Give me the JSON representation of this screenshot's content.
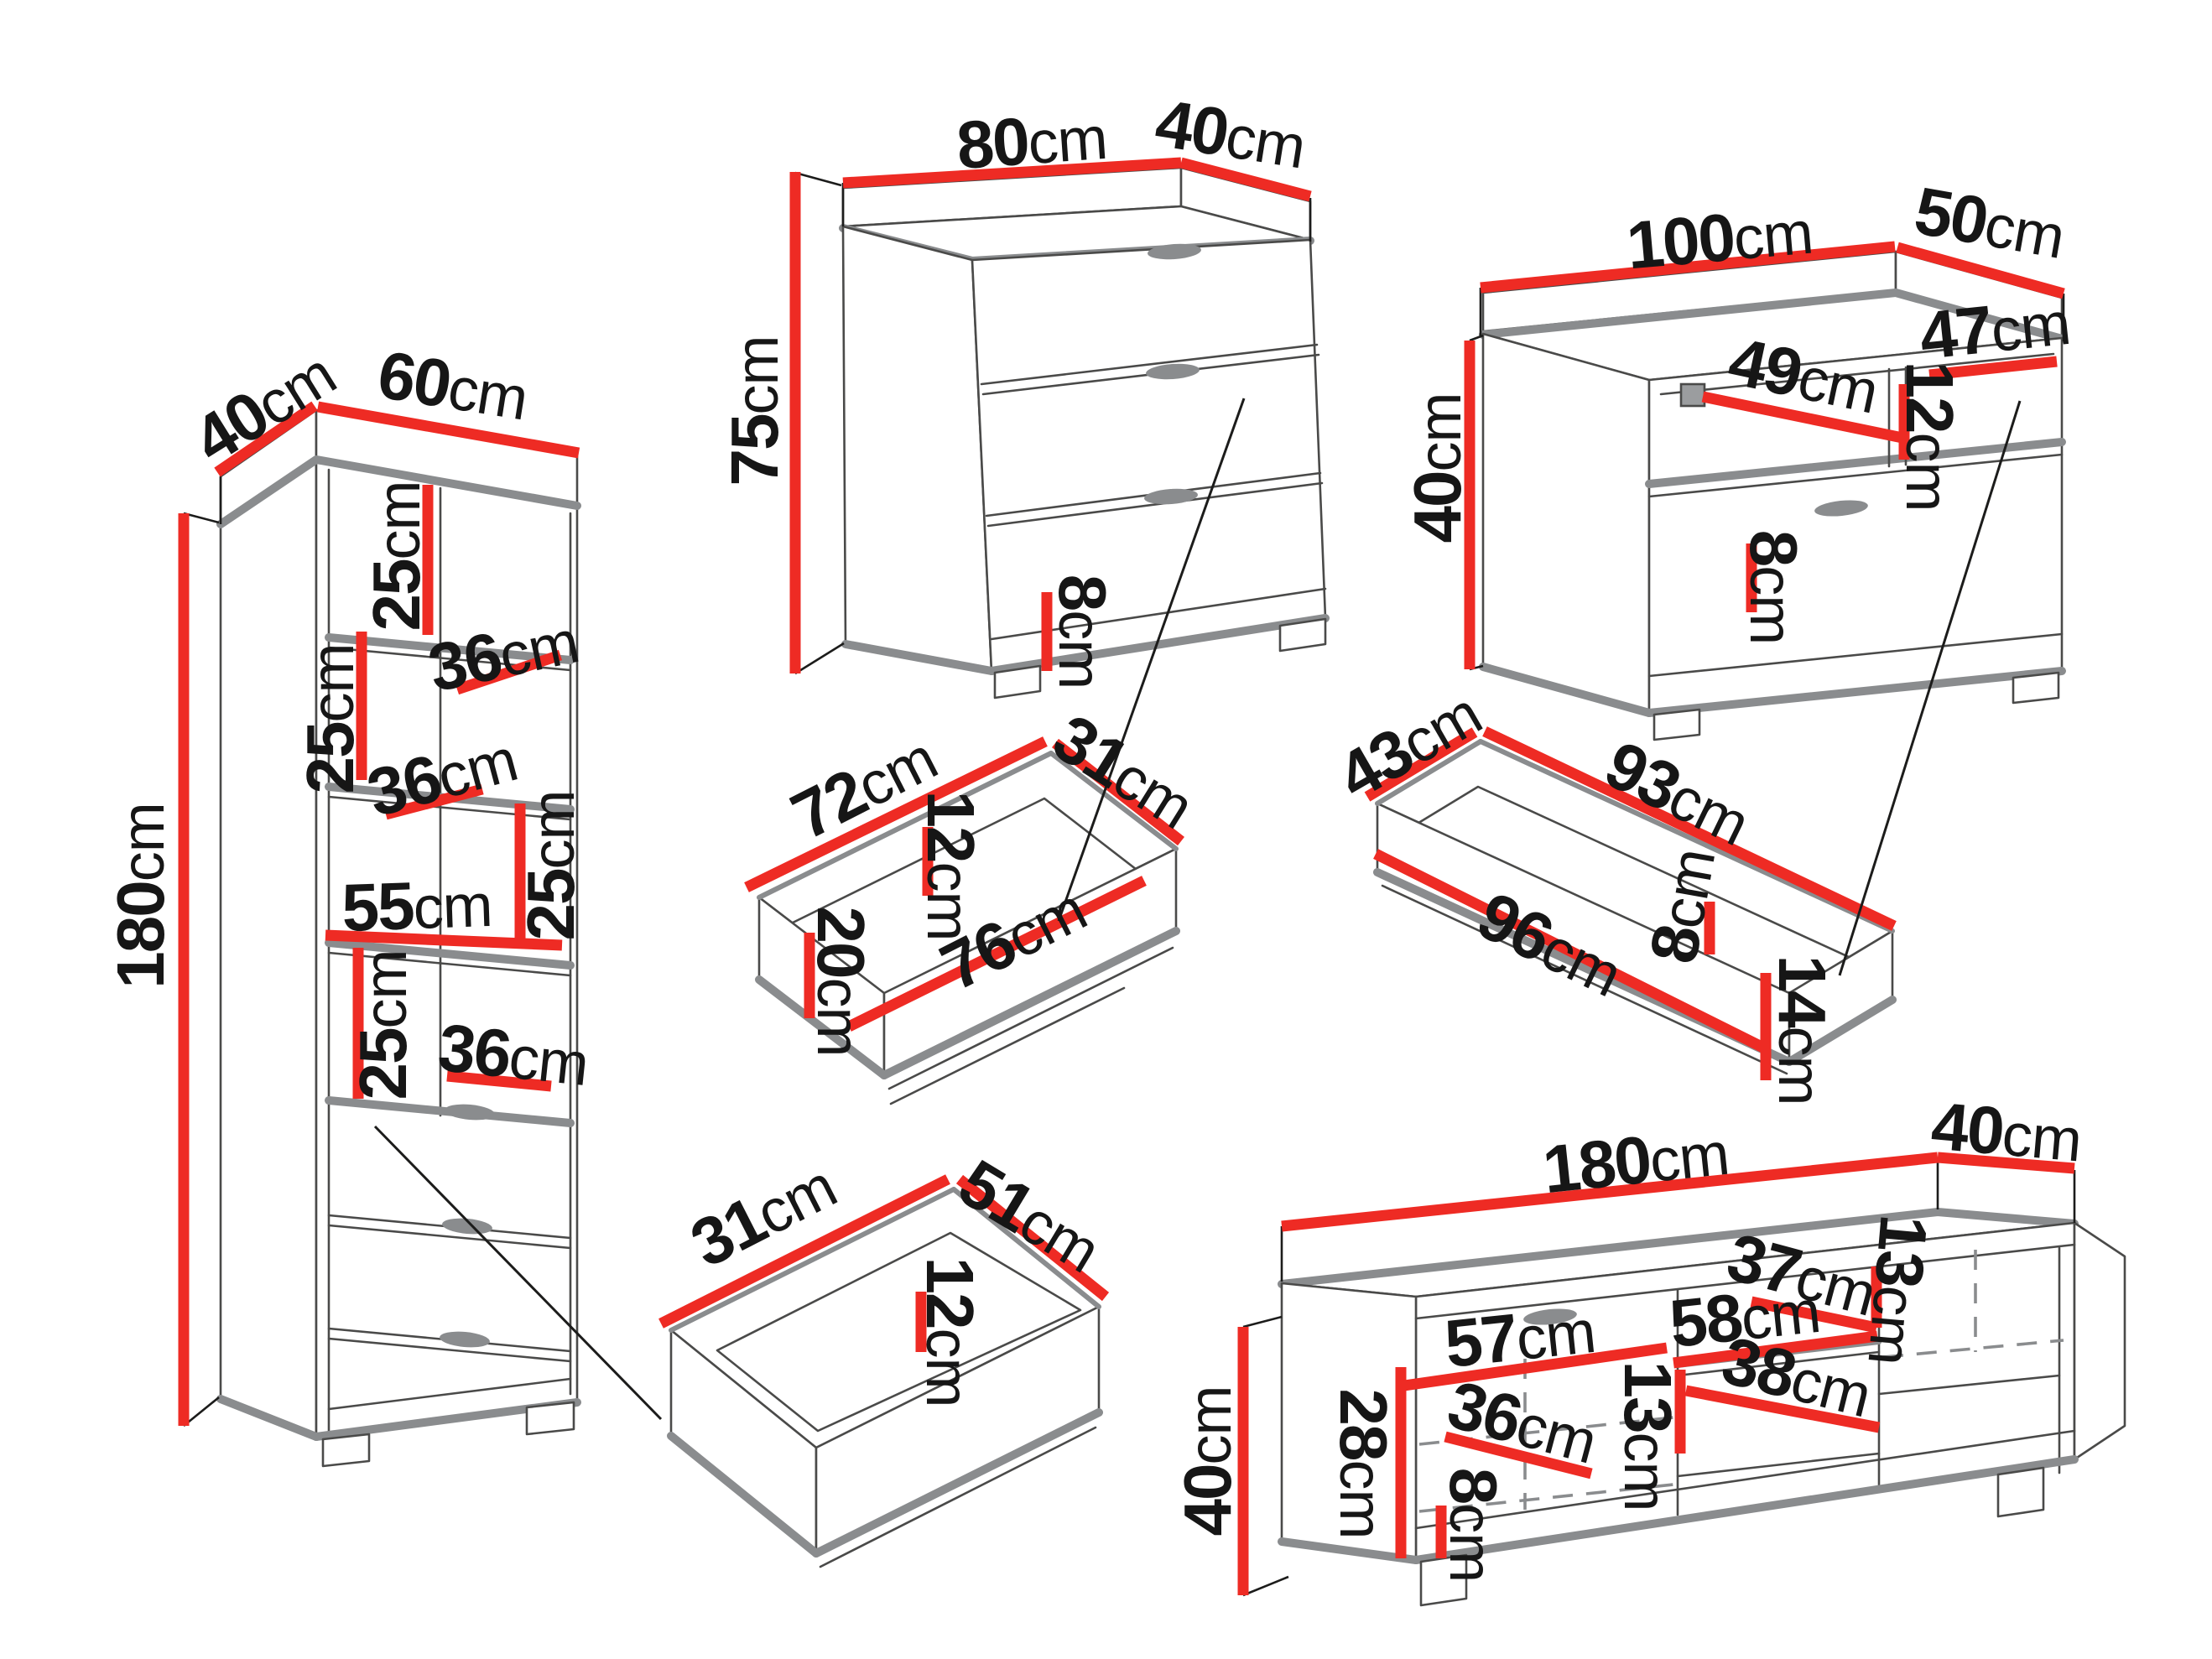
{
  "diagram": {
    "background": "#ffffff",
    "dimension_line_color": "#ee2b24",
    "furniture_outline_color": "#8a8c8e",
    "edge_line_color": "#3a3a39",
    "label_color": "#161616",
    "unit": "cm"
  },
  "pieces": {
    "tall_cabinet": {
      "name": "Tall shelving cabinet with drawers",
      "dims": {
        "depth": {
          "v": "40",
          "u": "cm"
        },
        "width": {
          "v": "60",
          "u": "cm"
        },
        "height": {
          "v": "180",
          "u": "cm"
        },
        "shelf1_height": {
          "v": "25",
          "u": "cm"
        },
        "shelf1_depth": {
          "v": "36",
          "u": "cm"
        },
        "shelf2_height": {
          "v": "25",
          "u": "cm"
        },
        "shelf2_depth": {
          "v": "36",
          "u": "cm"
        },
        "shelf3_height": {
          "v": "25",
          "u": "cm"
        },
        "inner_width": {
          "v": "55",
          "u": "cm"
        },
        "shelf4_height": {
          "v": "25",
          "u": "cm"
        },
        "shelf4_depth": {
          "v": "36",
          "u": "cm"
        }
      }
    },
    "chest": {
      "name": "Chest of three drawers",
      "dims": {
        "width": {
          "v": "80",
          "u": "cm"
        },
        "depth": {
          "v": "40",
          "u": "cm"
        },
        "height": {
          "v": "75",
          "u": "cm"
        },
        "plinth_height": {
          "v": "8",
          "u": "cm"
        }
      }
    },
    "chest_drawer": {
      "name": "Chest drawer box",
      "dims": {
        "back_width": {
          "v": "72",
          "u": "cm"
        },
        "side_depth": {
          "v": "31",
          "u": "cm"
        },
        "inner_height": {
          "v": "12",
          "u": "cm"
        },
        "front_height": {
          "v": "20",
          "u": "cm"
        },
        "front_width": {
          "v": "76",
          "u": "cm"
        }
      }
    },
    "tv_cabinet": {
      "name": "TV cabinet",
      "dims": {
        "width": {
          "v": "100",
          "u": "cm"
        },
        "depth": {
          "v": "50",
          "u": "cm"
        },
        "height": {
          "v": "40",
          "u": "cm"
        },
        "niche_width": {
          "v": "47",
          "u": "cm"
        },
        "niche_diagonal": {
          "v": "49",
          "u": "cm"
        },
        "niche_height": {
          "v": "12",
          "u": "cm"
        },
        "plinth_height": {
          "v": "8",
          "u": "cm"
        }
      }
    },
    "tv_cabinet_drawer": {
      "name": "TV cabinet drawer box",
      "dims": {
        "side_depth": {
          "v": "43",
          "u": "cm"
        },
        "back_width": {
          "v": "93",
          "u": "cm"
        },
        "front_width": {
          "v": "96",
          "u": "cm"
        },
        "inner_height": {
          "v": "8",
          "u": "cm"
        },
        "front_height": {
          "v": "14",
          "u": "cm"
        }
      }
    },
    "small_drawer": {
      "name": "Small drawer box",
      "dims": {
        "side_depth": {
          "v": "31",
          "u": "cm"
        },
        "width": {
          "v": "51",
          "u": "cm"
        },
        "inner_height": {
          "v": "12",
          "u": "cm"
        }
      }
    },
    "tv_stand": {
      "name": "Long TV stand",
      "dims": {
        "width": {
          "v": "180",
          "u": "cm"
        },
        "depth": {
          "v": "40",
          "u": "cm"
        },
        "height": {
          "v": "40",
          "u": "cm"
        },
        "inner_height": {
          "v": "28",
          "u": "cm"
        },
        "left_width": {
          "v": "57",
          "u": "cm"
        },
        "top_depth": {
          "v": "37",
          "u": "cm"
        },
        "mid_width": {
          "v": "58",
          "u": "cm"
        },
        "niche_height_right": {
          "v": "13",
          "u": "cm"
        },
        "mid_depth": {
          "v": "38",
          "u": "cm"
        },
        "left_depth": {
          "v": "36",
          "u": "cm"
        },
        "niche_height_mid": {
          "v": "13",
          "u": "cm"
        },
        "plinth_height": {
          "v": "8",
          "u": "cm"
        }
      }
    }
  }
}
